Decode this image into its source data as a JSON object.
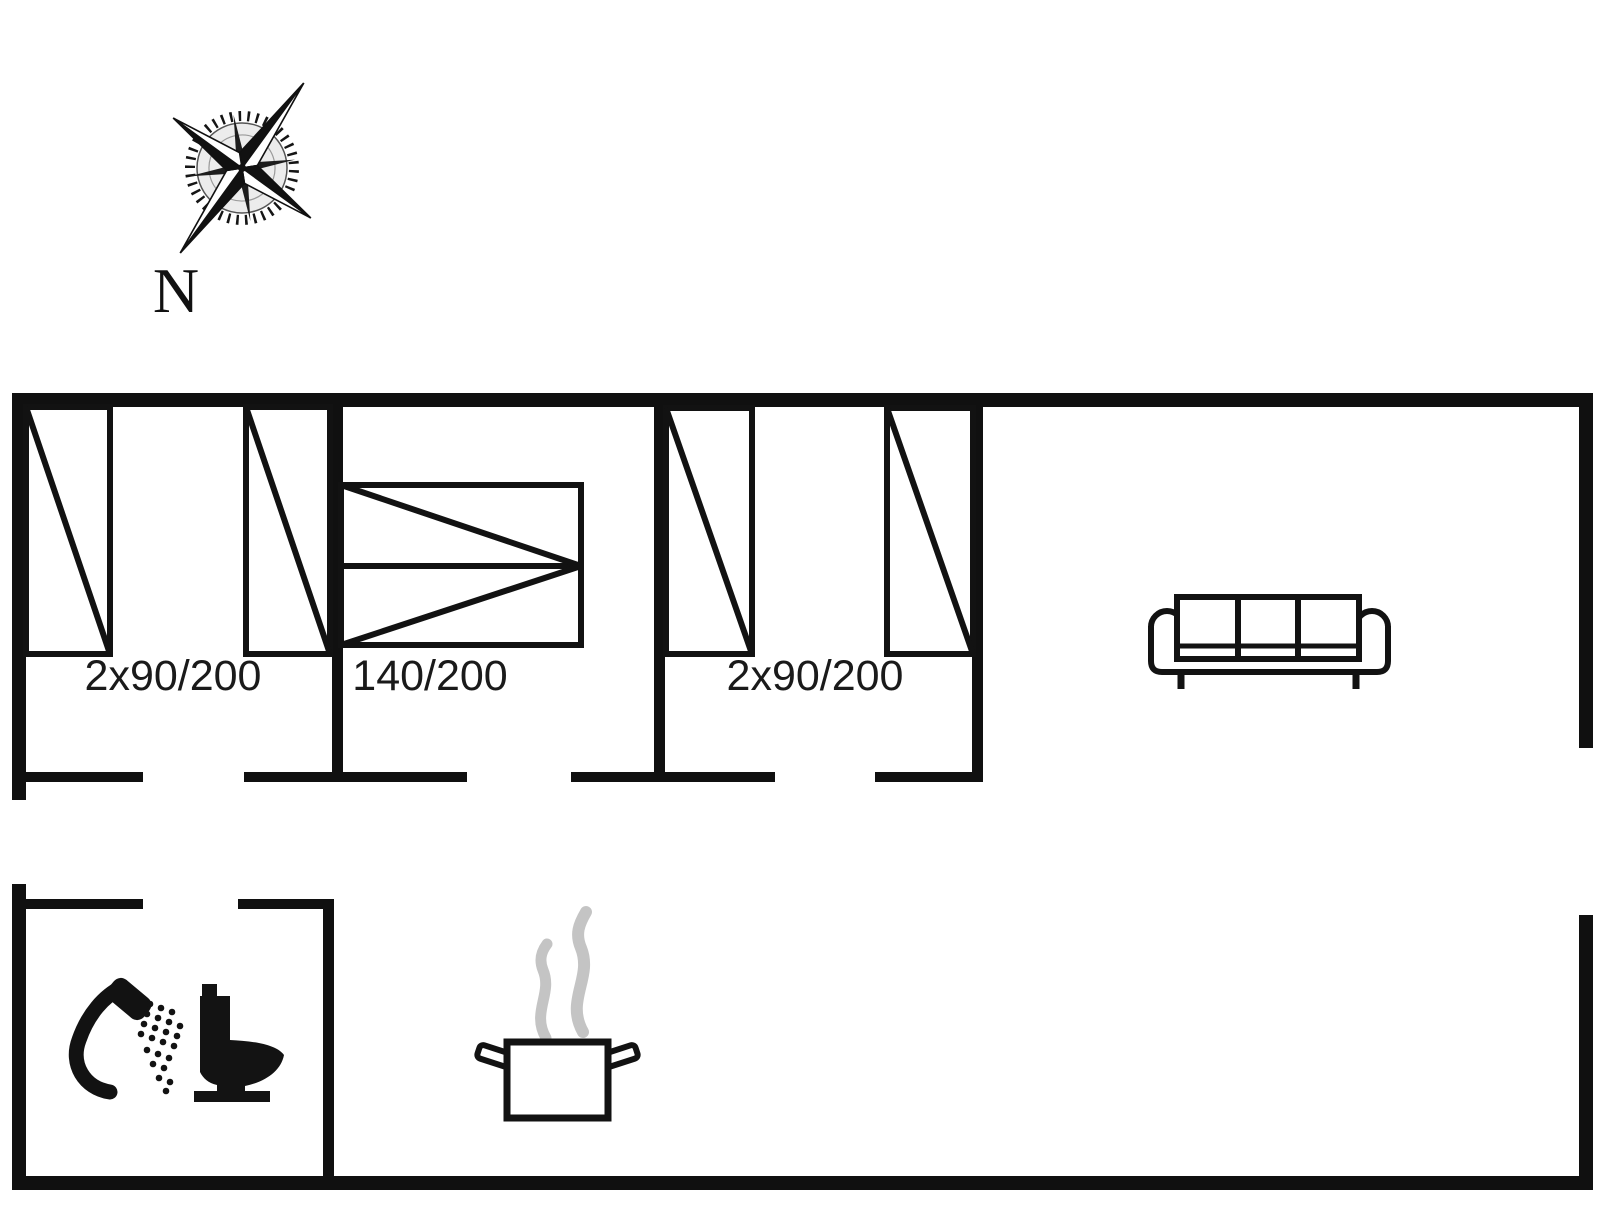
{
  "floor_plan": {
    "type": "floor-plan",
    "compass": {
      "label": "N"
    },
    "rooms": {
      "bedroom_1": {
        "bed_label": "2x90/200"
      },
      "bedroom_2": {
        "bed_label": "140/200"
      },
      "bedroom_3": {
        "bed_label": "2x90/200"
      }
    },
    "icons": [
      "compass-rose-icon",
      "single-bed-symbol",
      "double-bed-symbol",
      "sofa-icon",
      "shower-icon",
      "toilet-icon",
      "cooking-pot-icon",
      "steam-icon"
    ],
    "colors": {
      "line": "#111111",
      "label_text": "#1a1a1a",
      "steam": "#c4c4c4",
      "background": "#ffffff"
    }
  }
}
